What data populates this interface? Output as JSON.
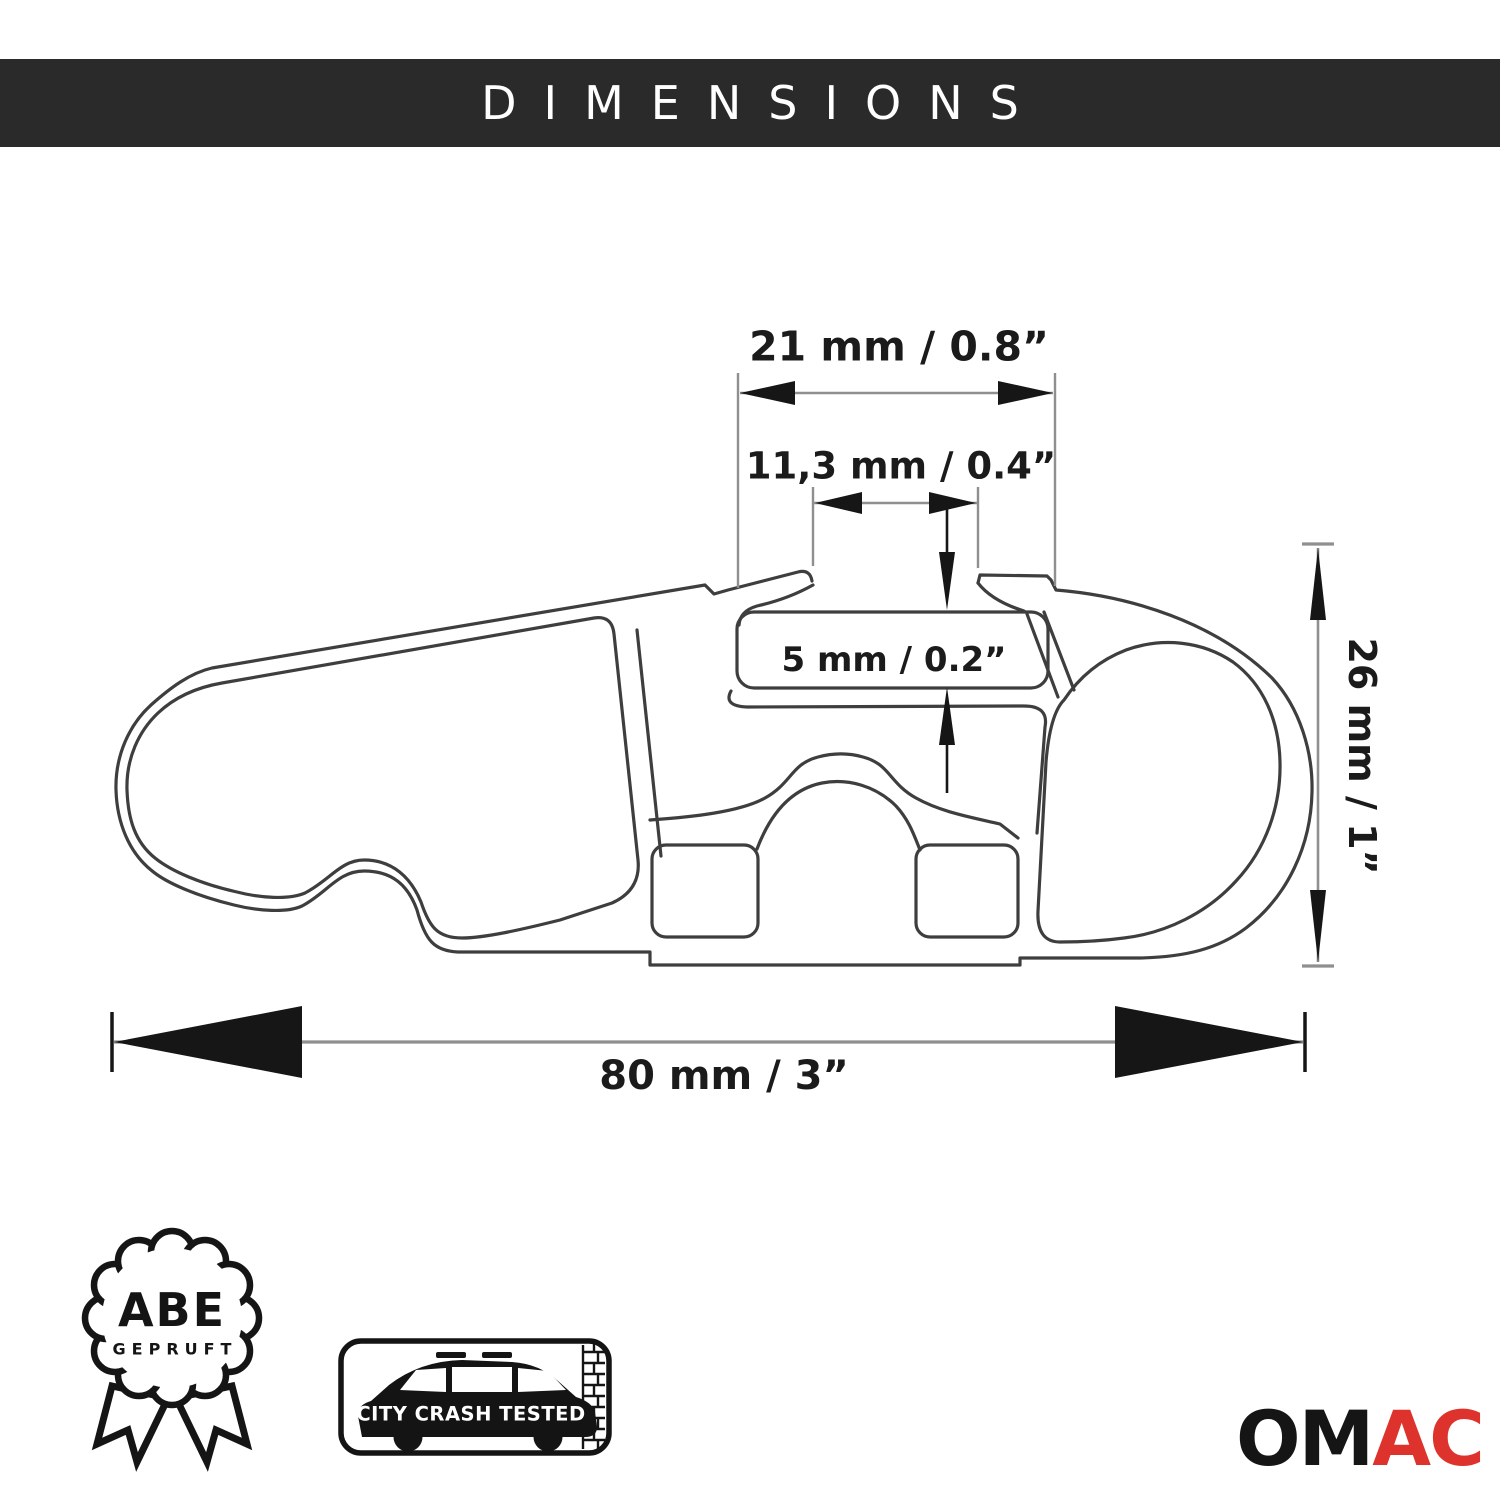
{
  "header": {
    "title": "DIMENSIONS"
  },
  "diagram": {
    "description": "Cross-section technical drawing of an aerodynamic roof rack crossbar profile",
    "dimensions": {
      "top_width": {
        "label": "21 mm / 0.8”"
      },
      "slot_width": {
        "label": "11,3 mm / 0.4”"
      },
      "wall_thickness": {
        "label": "5 mm / 0.2”"
      },
      "height": {
        "label": "26 mm / 1”"
      },
      "total_width": {
        "label": "80 mm / 3”"
      }
    }
  },
  "badges": {
    "abe": {
      "line1": "ABE",
      "line2": "GEPRUFT"
    },
    "crash": {
      "label": "CITY CRASH TESTED"
    }
  },
  "logo": {
    "part1": "OM",
    "part2": "AC"
  },
  "colors": {
    "header_bg": "#2b2a2a",
    "header_text": "#ffffff",
    "profile_line": "#3e3e3e",
    "dimension_line": "#8f8f8f",
    "arrow": "#161616",
    "badge_ink": "#141414",
    "logo_black": "#151515",
    "logo_red": "#de332d",
    "background": "#ffffff"
  }
}
